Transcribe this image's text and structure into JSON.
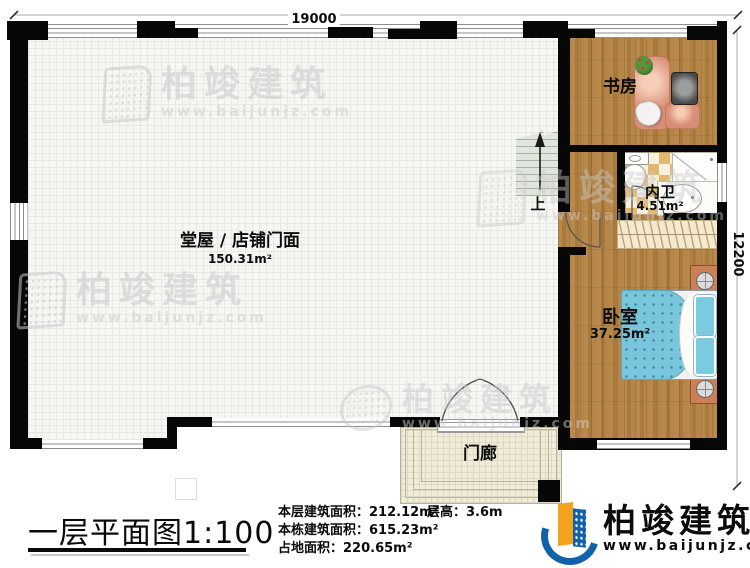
{
  "dimensions": {
    "width_label": "19000",
    "height_label": "12200"
  },
  "rooms": {
    "hall": {
      "name": "堂屋 / 店铺门面",
      "area": "150.31m²"
    },
    "study": {
      "name": "书房"
    },
    "bathroom": {
      "name": "内卫",
      "area": "4.51m²"
    },
    "bedroom": {
      "name": "卧室",
      "area": "37.25m²"
    },
    "porch": {
      "name": "门廊"
    }
  },
  "stairs": {
    "direction_label": "上"
  },
  "footer": {
    "plan_title": "一层平面图",
    "plan_scale": "1:100",
    "stats": [
      {
        "label": "本层建筑面积：",
        "value": "212.12m²"
      },
      {
        "label": "本栋建筑面积：",
        "value": "615.23m²"
      },
      {
        "label": "占地面积：",
        "value": "220.65m²"
      }
    ],
    "floor_height": {
      "label": "层高：",
      "value": "3.6m"
    }
  },
  "brand": {
    "name": "柏竣建筑",
    "website": "www.baijunjz.com"
  },
  "watermark": {
    "text": "柏竣建筑",
    "website": "www.baijunjz.com"
  },
  "colors": {
    "wall": "#070707",
    "wood_floor": "#b0813f",
    "hall_floor": "#f6f6f3",
    "bathroom_tile": "#e3b76e",
    "stairs": "#e0e6dd",
    "porch": "#f0ecd9",
    "desk": "#d98f76",
    "bed_blanket": "#79c6dc",
    "nightstand": "#cd8055",
    "brand_blue": "#1262aa",
    "brand_orange": "#f2a21c",
    "watermark_gray": "#c9c9c9"
  }
}
